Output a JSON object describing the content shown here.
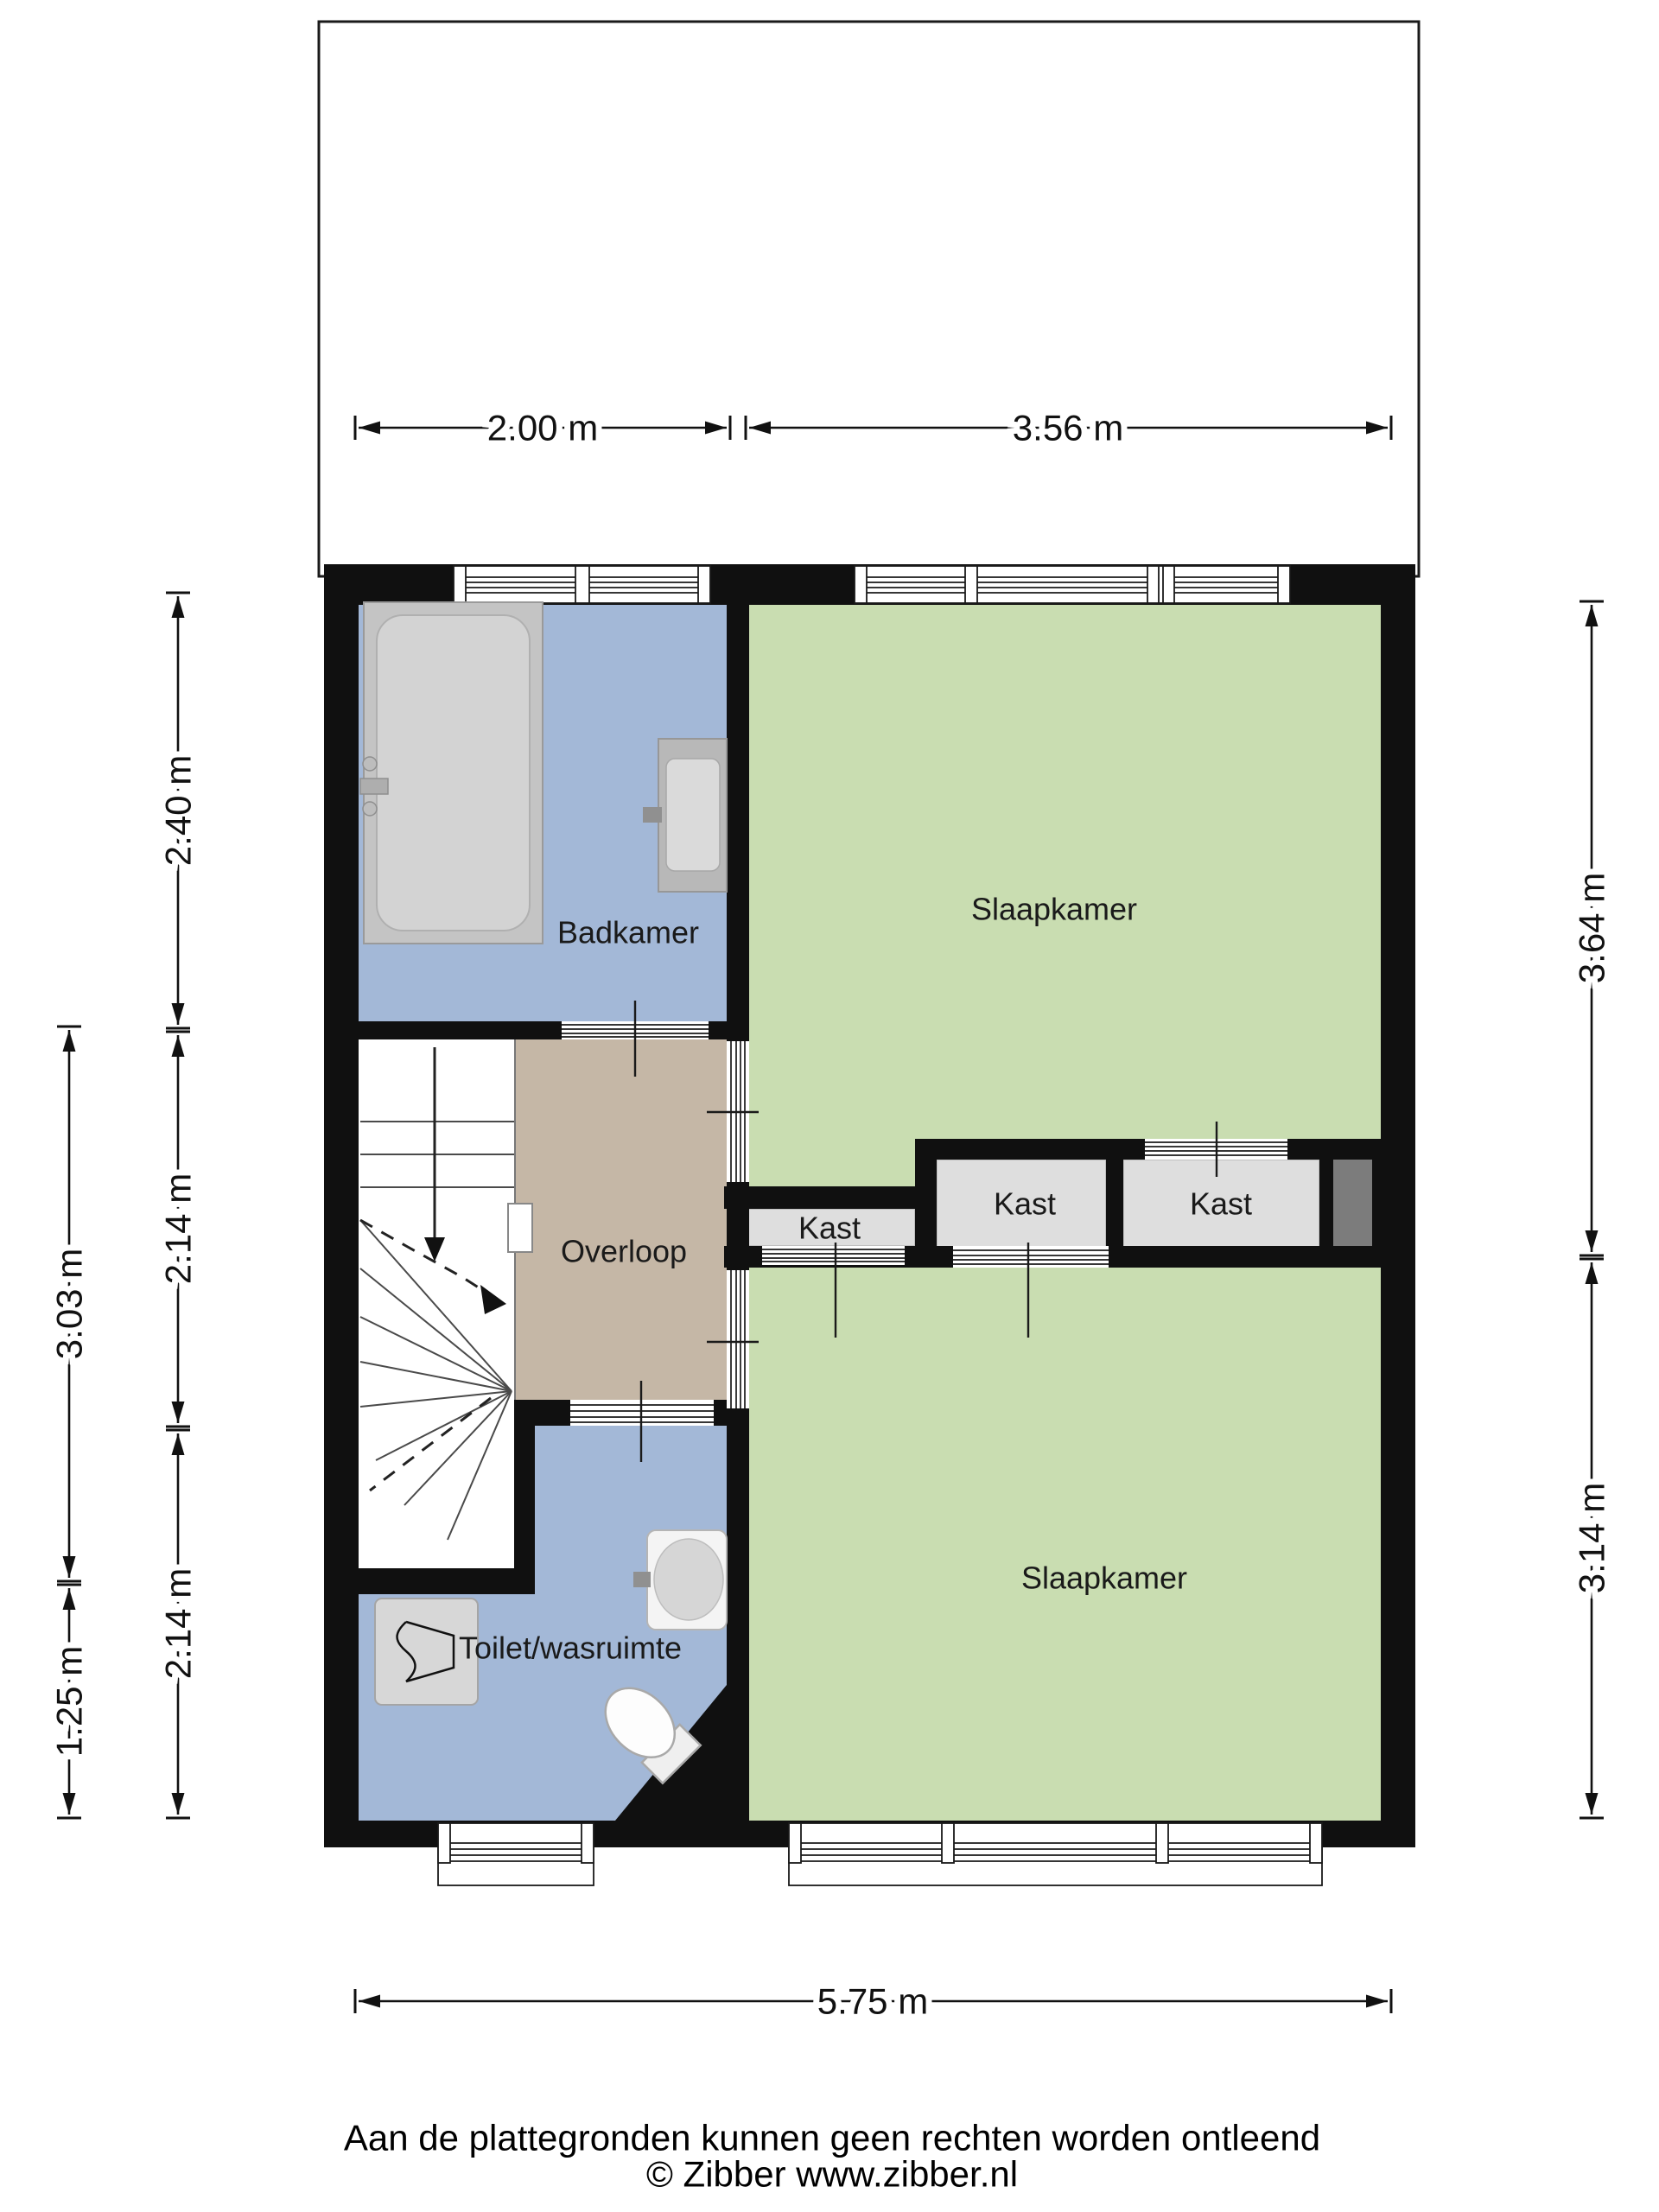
{
  "rooms": {
    "badkamer": "Badkamer",
    "slaapkamer_boven": "Slaapkamer",
    "overloop": "Overloop",
    "kast_klein": "Kast",
    "kast_midden": "Kast",
    "kast_rechts": "Kast",
    "toilet_wasruimte": "Toilet/wasruimte",
    "slaapkamer_beneden": "Slaapkamer"
  },
  "dimensions": {
    "top": [
      "2.00 m",
      "3.56 m"
    ],
    "left_inner": [
      "2.40 m",
      "2.14 m",
      "2.14 m"
    ],
    "left_outer": [
      "3.03 m",
      "1.25 m"
    ],
    "right": [
      "3.64 m",
      "3.14 m"
    ],
    "bottom": "5.75 m"
  },
  "footer": {
    "disclaimer": "Aan de plattegronden kunnen geen rechten worden ontleend",
    "copyright": "© Zibber www.zibber.nl"
  },
  "colors": {
    "wall": "#101010",
    "bedroom": "#c9ddb1",
    "bathroom": "#a3b8d7",
    "hallway": "#c5b7a6",
    "closet": "#dedede",
    "closet_niche": "#7c7c7c",
    "stairs": "#ffffff",
    "garden": "#ffffff"
  }
}
